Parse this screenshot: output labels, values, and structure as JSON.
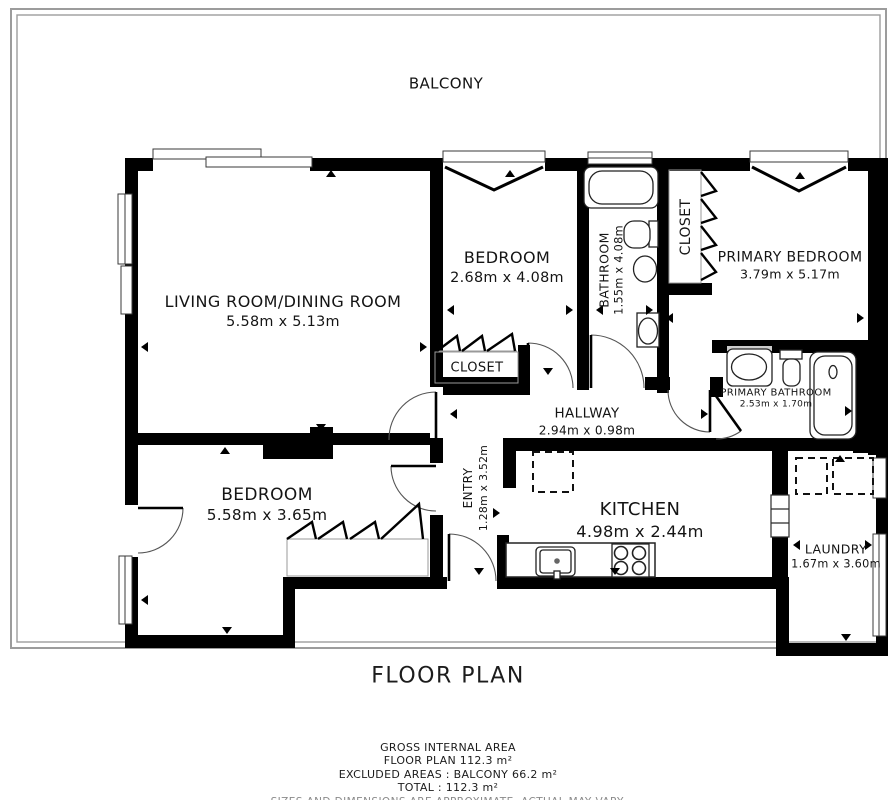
{
  "title": "FLOOR PLAN",
  "balcony": {
    "name": "BALCONY"
  },
  "rooms": {
    "living": {
      "name": "LIVING ROOM/DINING ROOM",
      "dims": "5.58m x 5.13m"
    },
    "bedroom_top": {
      "name": "BEDROOM",
      "dims": "2.68m x 4.08m"
    },
    "bathroom": {
      "name": "BATHROOM",
      "dims": "1.55m x 4.08m"
    },
    "closet_top": {
      "name": "CLOSET"
    },
    "primary_bedroom": {
      "name": "PRIMARY BEDROOM",
      "dims": "3.79m x 5.17m"
    },
    "closet_mid": {
      "name": "CLOSET"
    },
    "hallway": {
      "name": "HALLWAY",
      "dims": "2.94m x 0.98m"
    },
    "entry": {
      "name": "ENTRY",
      "dims": "1.28m x 3.52m"
    },
    "primary_bathroom": {
      "name": "PRIMARY BATHROOM",
      "dims": "2.53m x 1.70m"
    },
    "bedroom_bottom": {
      "name": "BEDROOM",
      "dims": "5.58m x 3.65m"
    },
    "kitchen": {
      "name": "KITCHEN",
      "dims": "4.98m x 2.44m"
    },
    "laundry": {
      "name": "LAUNDRY",
      "dims": "1.67m x 3.60m"
    }
  },
  "footer": {
    "area_heading": "GROSS INTERNAL AREA",
    "floor_plan_area": "FLOOR PLAN 112.3 m²",
    "excluded_areas": "EXCLUDED AREAS :  BALCONY 66.2 m²",
    "total": "TOTAL :  112.3 m²",
    "disclaimer": "SIZES AND DIMENSIONS ARE APPROXIMATE, ACTUAL MAY VARY."
  },
  "colors": {
    "wall": "#000000",
    "balcony_line": "#9c9c9c",
    "disclaimer_text": "#8a8a8a"
  }
}
